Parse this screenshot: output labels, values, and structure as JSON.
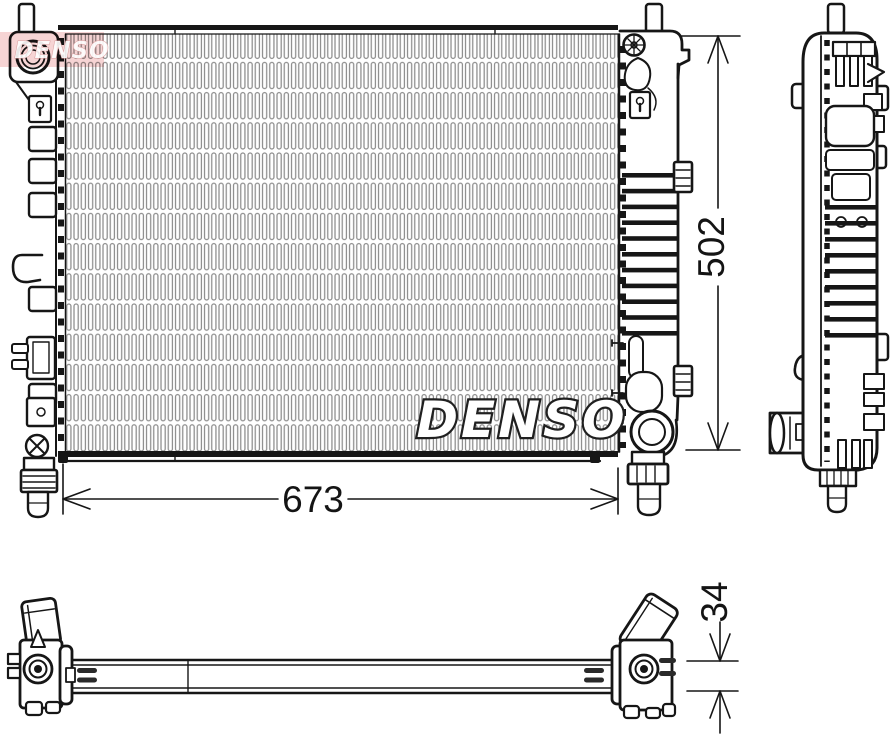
{
  "drawing": {
    "watermark_center": "DENSO",
    "watermark_corner": "DENSO",
    "dim_width": "673",
    "dim_height": "502",
    "dim_depth": "34",
    "colors": {
      "line": "#161616",
      "fin_gray": "#8c8c8c",
      "pink_overlay": "#eeb0b0",
      "background": "#ffffff"
    }
  }
}
